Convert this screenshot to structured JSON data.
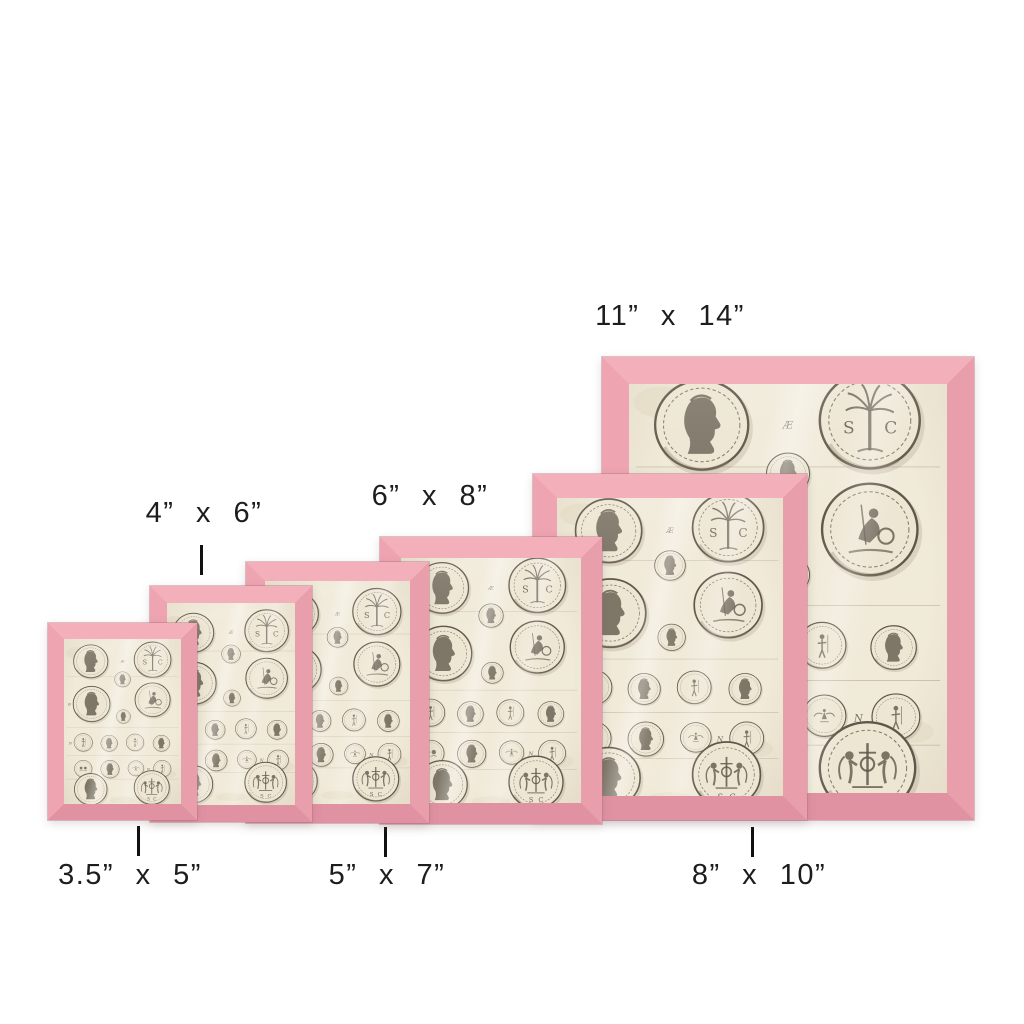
{
  "canvas": {
    "width": 1024,
    "height": 1024,
    "background": "#ffffff"
  },
  "palette": {
    "background": "#ffffff",
    "pink_top": "#f3b0bb",
    "pink_left": "#eea4b1",
    "pink_right": "#e99eac",
    "pink_bottom": "#e092a2",
    "paper": "#f0ead9",
    "ink": "#5f574a",
    "ink_soft": "#8a7f6b",
    "label": "#1d1d1d",
    "tick": "#111111"
  },
  "artwork": {
    "subject": "antique engraved plate of Roman coins",
    "marks": [
      "Æ",
      "B",
      "N",
      "N"
    ],
    "letters": {
      "s": "S",
      "c": "C"
    }
  },
  "frames": [
    {
      "id": "3-5x5",
      "x": 48,
      "y": 623,
      "w": 149,
      "h": 197,
      "border": 16,
      "z": 60,
      "label": {
        "text": "3.5” x 5”",
        "cx": 130,
        "y": 860
      },
      "tick": {
        "x": 137,
        "y": 826
      }
    },
    {
      "id": "4x6",
      "x": 150,
      "y": 586,
      "w": 162,
      "h": 236,
      "border": 17,
      "z": 50,
      "label": {
        "text": "4” x 6”",
        "cx": 204,
        "y": 498
      },
      "tick": {
        "x": 200,
        "y": 545
      }
    },
    {
      "id": "5x7",
      "x": 246,
      "y": 562,
      "w": 183,
      "h": 261,
      "border": 19,
      "z": 40,
      "label": {
        "text": "5” x 7”",
        "cx": 387,
        "y": 860
      },
      "tick": {
        "x": 384,
        "y": 827
      }
    },
    {
      "id": "6x8",
      "x": 380,
      "y": 537,
      "w": 222,
      "h": 287,
      "border": 21,
      "z": 30,
      "label": {
        "text": "6” x 8”",
        "cx": 430,
        "y": 481
      },
      "tick": null
    },
    {
      "id": "8x10",
      "x": 533,
      "y": 474,
      "w": 274,
      "h": 346,
      "border": 24,
      "z": 20,
      "label": {
        "text": "8” x 10”",
        "cx": 759,
        "y": 860
      },
      "tick": {
        "x": 751,
        "y": 827
      }
    },
    {
      "id": "11x14",
      "x": 602,
      "y": 357,
      "w": 372,
      "h": 463,
      "border": 27,
      "z": 10,
      "label": {
        "text": "11” x 14”",
        "cx": 670,
        "y": 301
      },
      "tick": null
    }
  ]
}
